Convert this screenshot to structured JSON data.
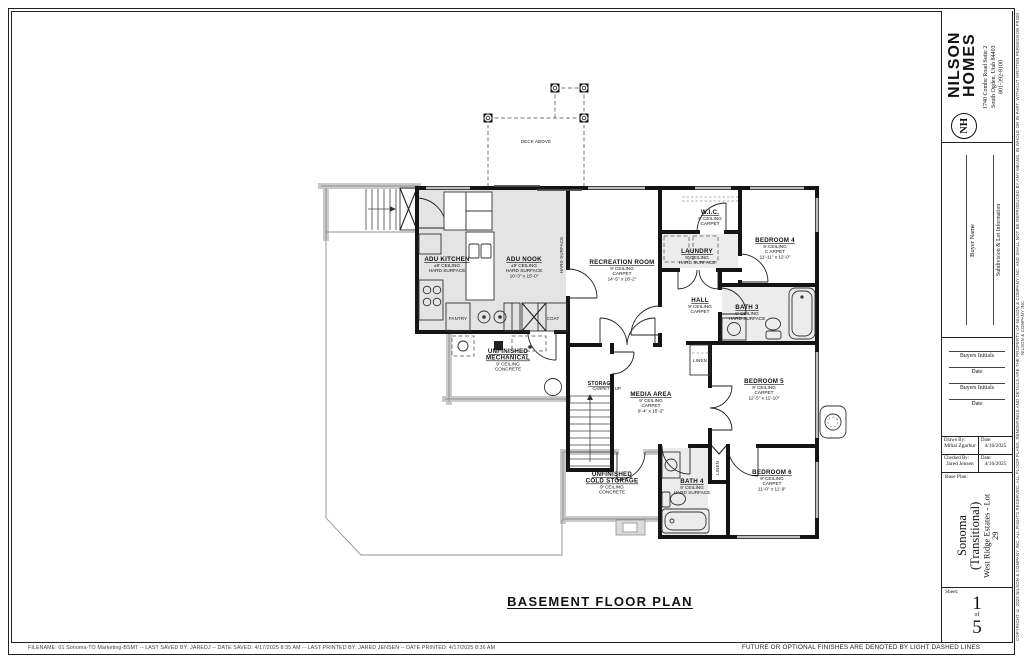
{
  "page": {
    "plan_title": "BASEMENT FLOOR PLAN",
    "footer_file_info": "FILENAME:  01 Sonoma-TO Marketing-BSMT   --   LAST SAVED BY:  JAREDJ   --   DATE SAVED:  4/17/2025 8:35 AM   --   LAST PRINTED BY:  JARED JENSEN   --   DATE PRINTED:  4/17/2025 8:36 AM",
    "footer_note": "FUTURE OR OPTIONAL FINISHES ARE DENOTED BY LIGHT DASHED LINES"
  },
  "title_block": {
    "brand_line1": "NILSON",
    "brand_line2": "HOMES",
    "monogram": "NH",
    "address_line1": "1740 Combe Road Suite 2",
    "address_line2": "South Ogden, Utah 84403",
    "phone": "801-392-8100",
    "buyer_name_label": "Buyer Name",
    "subdivision_label": "Subdivision & Lot Information",
    "sig1_label": "Buyers Initials",
    "sig2_label": "Date",
    "sig3_label": "Buyers Initials",
    "sig4_label": "Date",
    "drawn_by_label": "Drawn By:",
    "drawn_by_value": "Mihai Zgarbur",
    "drawn_date_label": "Date:",
    "drawn_date_value": "4/16/2025",
    "checked_by_label": "Checked By:",
    "checked_by_value": "Jared Jensen",
    "checked_date_label": "Date:",
    "checked_date_value": "4/16/2025",
    "base_plan_label": "Base Plan:",
    "plan_name": "Sonoma",
    "plan_variant": "(Transitional)",
    "plan_lot": "West Ridge Estates - Lot 29",
    "sheet_label": "Sheet:",
    "sheet_number": "1",
    "sheet_of": "of",
    "sheet_total": "5",
    "copyright": "COPYRIGHT ©  2023  NILSON & COMPANY INC.  ALL RIGHTS RESERVED.  ALL FLOOR PLANS, RENDERINGS AND DETAILS ARE THE PROPERTY OF NILSON & COMPANY INC. AND SHALL NOT BE REPRODUCED BY ANY MEANS, IN WHOLE OR IN PART, WITHOUT WRITTEN PERMISSION FROM NILSON & COMPANY INC."
  },
  "plan": {
    "rooms": [
      {
        "n1": "ADU KITCHEN",
        "n2": "",
        "d1": "±9' CEILING",
        "d2": "HARD SURFACE",
        "d3": ""
      },
      {
        "n1": "ADU NOOK",
        "n2": "",
        "d1": "±9' CEILING",
        "d2": "HARD SURFACE",
        "d3": "10'-3\" x 15'-0\""
      },
      {
        "n1": "RECREATION ROOM",
        "n2": "",
        "d1": "9' CEILING",
        "d2": "CARPET",
        "d3": "14'-5\" x 18'-2\""
      },
      {
        "n1": "W.I.C.",
        "n2": "",
        "d1": "9' CEILING",
        "d2": "CARPET",
        "d3": ""
      },
      {
        "n1": "LAUNDRY",
        "n2": "",
        "d1": "9' CEILING",
        "d2": "HARD SURFACE",
        "d3": ""
      },
      {
        "n1": "BEDROOM 4",
        "n2": "",
        "d1": "9' CEILING",
        "d2": "C ARPET",
        "d3": "11'-11\" x 12'-0\""
      },
      {
        "n1": "BATH 3",
        "n2": "",
        "d1": "9' CEILING",
        "d2": "HARD SURFACE",
        "d3": ""
      },
      {
        "n1": "HALL",
        "n2": "",
        "d1": "9' CEILING",
        "d2": "CARPET",
        "d3": ""
      },
      {
        "n1": "BEDROOM 5",
        "n2": "",
        "d1": "9' CEILING",
        "d2": "CARPET",
        "d3": "12'-5\" x 11'-10\""
      },
      {
        "n1": "MEDIA AREA",
        "n2": "",
        "d1": "9' CEILING",
        "d2": "CARPET",
        "d3": "9'-4\" x 15'-2\""
      },
      {
        "n1": "STORAGE",
        "n2": "",
        "d1": "CARPET",
        "d2": "",
        "d3": ""
      },
      {
        "n1": "UNFINISHED",
        "n2": "MECHANICAL",
        "d1": "9' CEILING",
        "d2": "CONCRETE",
        "d3": ""
      },
      {
        "n1": "UNFINISHED",
        "n2": "COLD STORAGE",
        "d1": "9' CEILING",
        "d2": "CONCRETE",
        "d3": ""
      },
      {
        "n1": "BATH 4",
        "n2": "",
        "d1": "9' CEILING",
        "d2": "HARD SURFACE",
        "d3": ""
      },
      {
        "n1": "BEDROOM 6",
        "n2": "",
        "d1": "9' CEILING",
        "d2": "CARPET",
        "d3": "11'-0\" x 11'-9\""
      }
    ],
    "labels": {
      "deck": "DECK ABOVE",
      "pantry": "PANTRY",
      "coat": "COAT",
      "linen1": "LINEN",
      "linen2": "LINEN",
      "up": "UP",
      "hard_surface": "HARD SURFACE"
    }
  },
  "colors": {
    "wall": "#141414",
    "concrete_wall": "#c9c9c9",
    "floor_shade": "#e4e4e4",
    "dashed_optional": "#777777"
  }
}
